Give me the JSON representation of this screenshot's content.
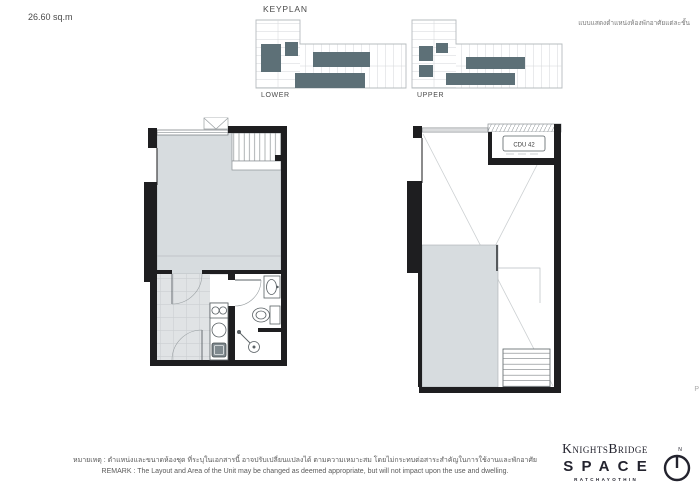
{
  "header": {
    "area": "26.60 sq.m",
    "keyplan_title": "KEYPLAN",
    "note_thai": "แบบแสดงตำแหน่งห้องพักอาศัยแต่ละชั้น"
  },
  "keyplan": {
    "lower_label": "LOWER",
    "upper_label": "UPPER"
  },
  "plans": {
    "cdu_label": "CDU 42"
  },
  "remark": {
    "thai": "หมายเหตุ : ตำแหน่งและขนาดห้องชุด ที่ระบุในเอกสารนี้ อาจปรับเปลี่ยนแปลงได้ ตามความเหมาะสม โดยไม่กระทบต่อสาระสำคัญในการใช้งานและพักอาศัย",
    "english": "REMARK :  The Layout and Area of the Unit may be changed as deemed appropriate, but will not impact upon the use and dwelling."
  },
  "logo": {
    "brand": "KnightsBridge",
    "name": "SPACE",
    "location": "RATCHAYOTHIN",
    "north": "N"
  },
  "misc": {
    "edge_text": "P"
  },
  "colors": {
    "wall": "#1e1e20",
    "room_fill": "#d7dcdf",
    "tile_fill": "#e0e3e5",
    "fixture_line": "#5a6165",
    "keyplan_highlight": "#5d7077",
    "keyplan_outline": "#b7bcbf",
    "text_dark": "#3c3c3c",
    "logo_color": "#23232e"
  }
}
